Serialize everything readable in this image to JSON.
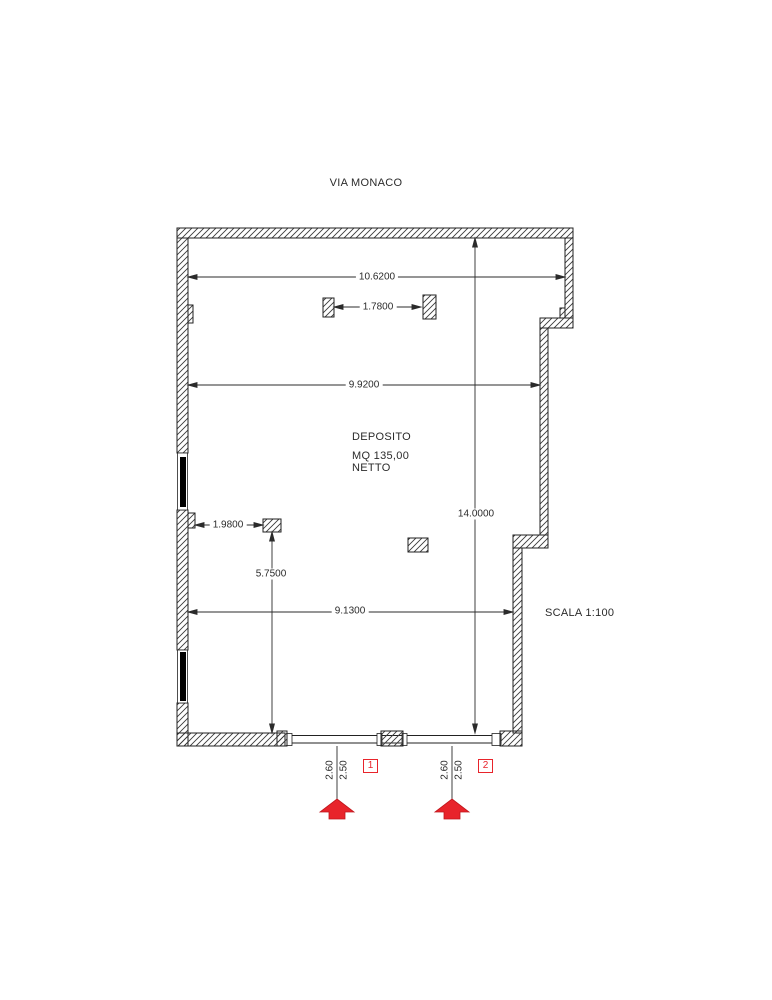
{
  "title": "VIA MONACO",
  "room": {
    "name": "DEPOSITO",
    "area": "MQ 135,00",
    "net": "NETTO"
  },
  "scale_label": "SCALA 1:100",
  "dimensions": {
    "top_width": "10.6200",
    "pillar_gap": "1.7800",
    "mid_width": "9.9200",
    "total_height": "14.0000",
    "left_offset": "1.9800",
    "lower_height": "5.7500",
    "bottom_width": "9.1300"
  },
  "entrances": [
    {
      "id": "1",
      "width_outer": "2.60",
      "width_inner": "2.50"
    },
    {
      "id": "2",
      "width_outer": "2.60",
      "width_inner": "2.50"
    }
  ],
  "colors": {
    "accent_red": "#e8242b",
    "line": "#2b2b2b",
    "wall_fill": "#ffffff"
  }
}
